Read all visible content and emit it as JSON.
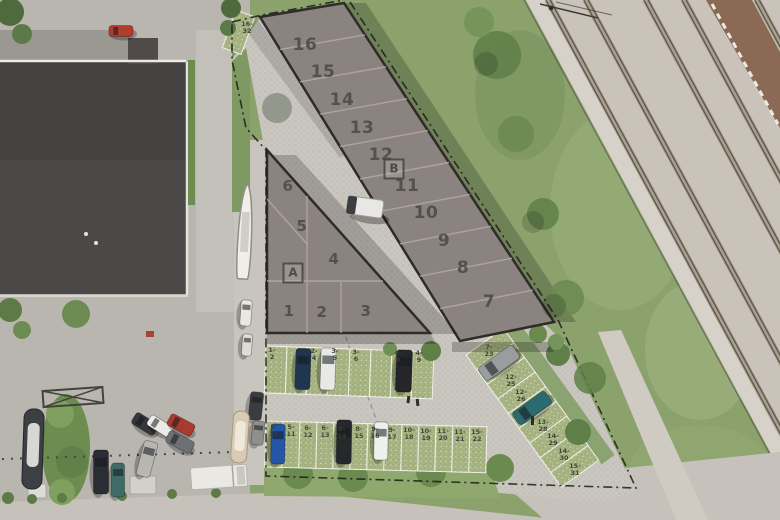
{
  "plan": {
    "building_a": {
      "label": "A",
      "units": [
        "1",
        "2",
        "3",
        "4",
        "5",
        "6"
      ]
    },
    "building_b": {
      "label": "B",
      "units": [
        "7",
        "8",
        "9",
        "10",
        "11",
        "12",
        "13",
        "14",
        "15",
        "16"
      ]
    },
    "parking_top_row": [
      "1-\n2",
      "",
      "2-\n4",
      "3-\n5",
      "3-\n6",
      "",
      "4-\n8",
      "4-\n9"
    ],
    "parking_bottom_row": [
      "5-\n10",
      "5-\n11",
      "6-\n12",
      "6-\n13",
      "8-\n14",
      "8-\n15",
      "9-\n16",
      "9-\n17",
      "10-\n18",
      "10-\n19",
      "11-\n20",
      "11-\n21",
      "15-\n22"
    ],
    "parking_right_row": [
      "7-\n23",
      "",
      "12-\n25",
      "12-\n26",
      "",
      "13-\n28",
      "14-\n29",
      "14-\n30",
      "15-\n31"
    ],
    "parking_spot_nw": "16-\n32",
    "colors": {
      "unit_roof": "#8b8380",
      "building_outline": "#2f2b28",
      "paving": "#cac6c0",
      "stall_green": "#a8b583",
      "number_text": "#4a453f",
      "grass": "#8ba26d",
      "railway_gravel": "#c9c3b9",
      "warehouse_roof": "#454140"
    }
  }
}
